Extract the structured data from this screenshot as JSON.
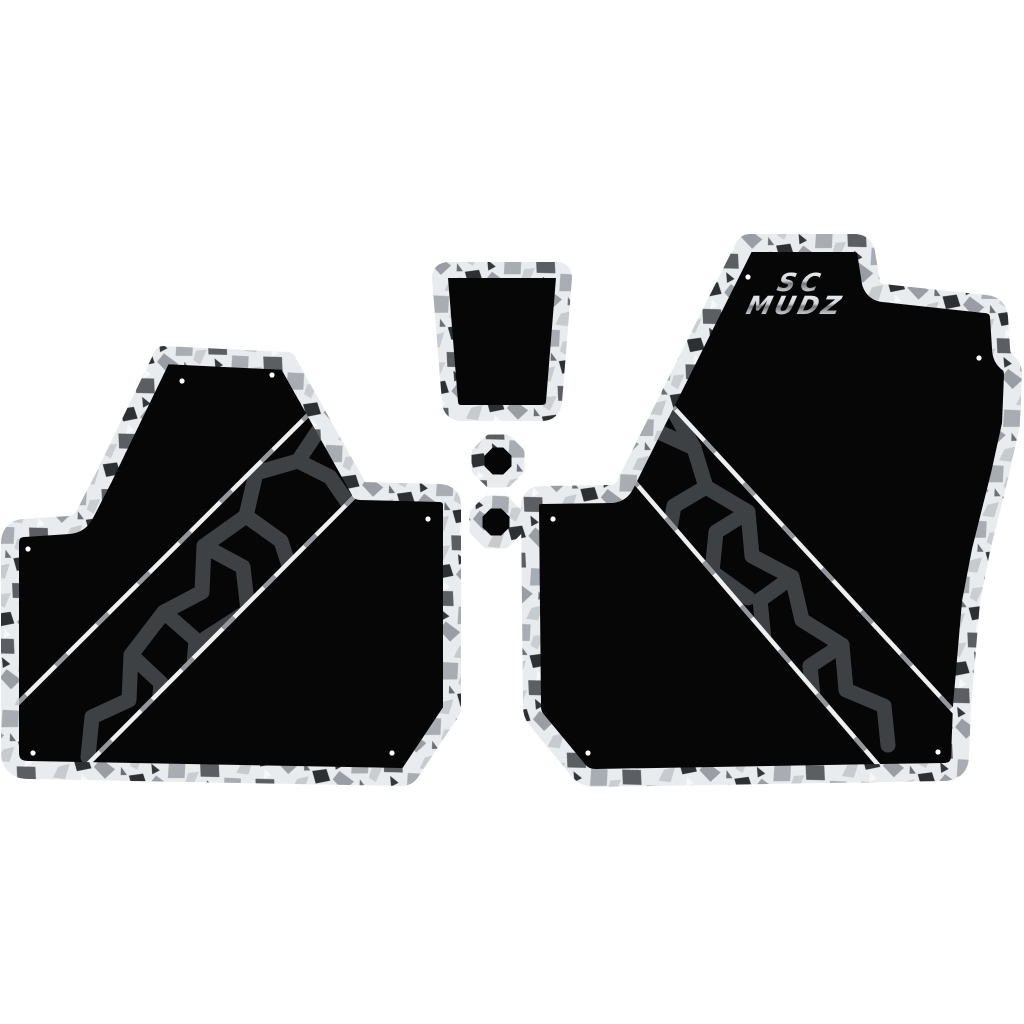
{
  "logo": {
    "line1": "SC",
    "line2": "MUDZ"
  },
  "colors": {
    "background": "#ffffff",
    "panel": "#060607",
    "crack": "#3e4144",
    "silver_line": "#edeff1",
    "silver_shadow": "#7d8287",
    "camo_base": "#e8ecef",
    "camo_dark": "#2d3033",
    "camo_mid": "#989ea4",
    "camo_light": "#c6cbd0",
    "hole": "#ffffff",
    "logo_outline": "#15181a"
  },
  "pieces": {
    "left_mat": "left-floor-mat",
    "console_pad": "center-console-pad",
    "upper_plug": "upper-octagon-plug",
    "lower_plug": "lower-octagon-plug",
    "right_mat": "right-floor-mat"
  }
}
